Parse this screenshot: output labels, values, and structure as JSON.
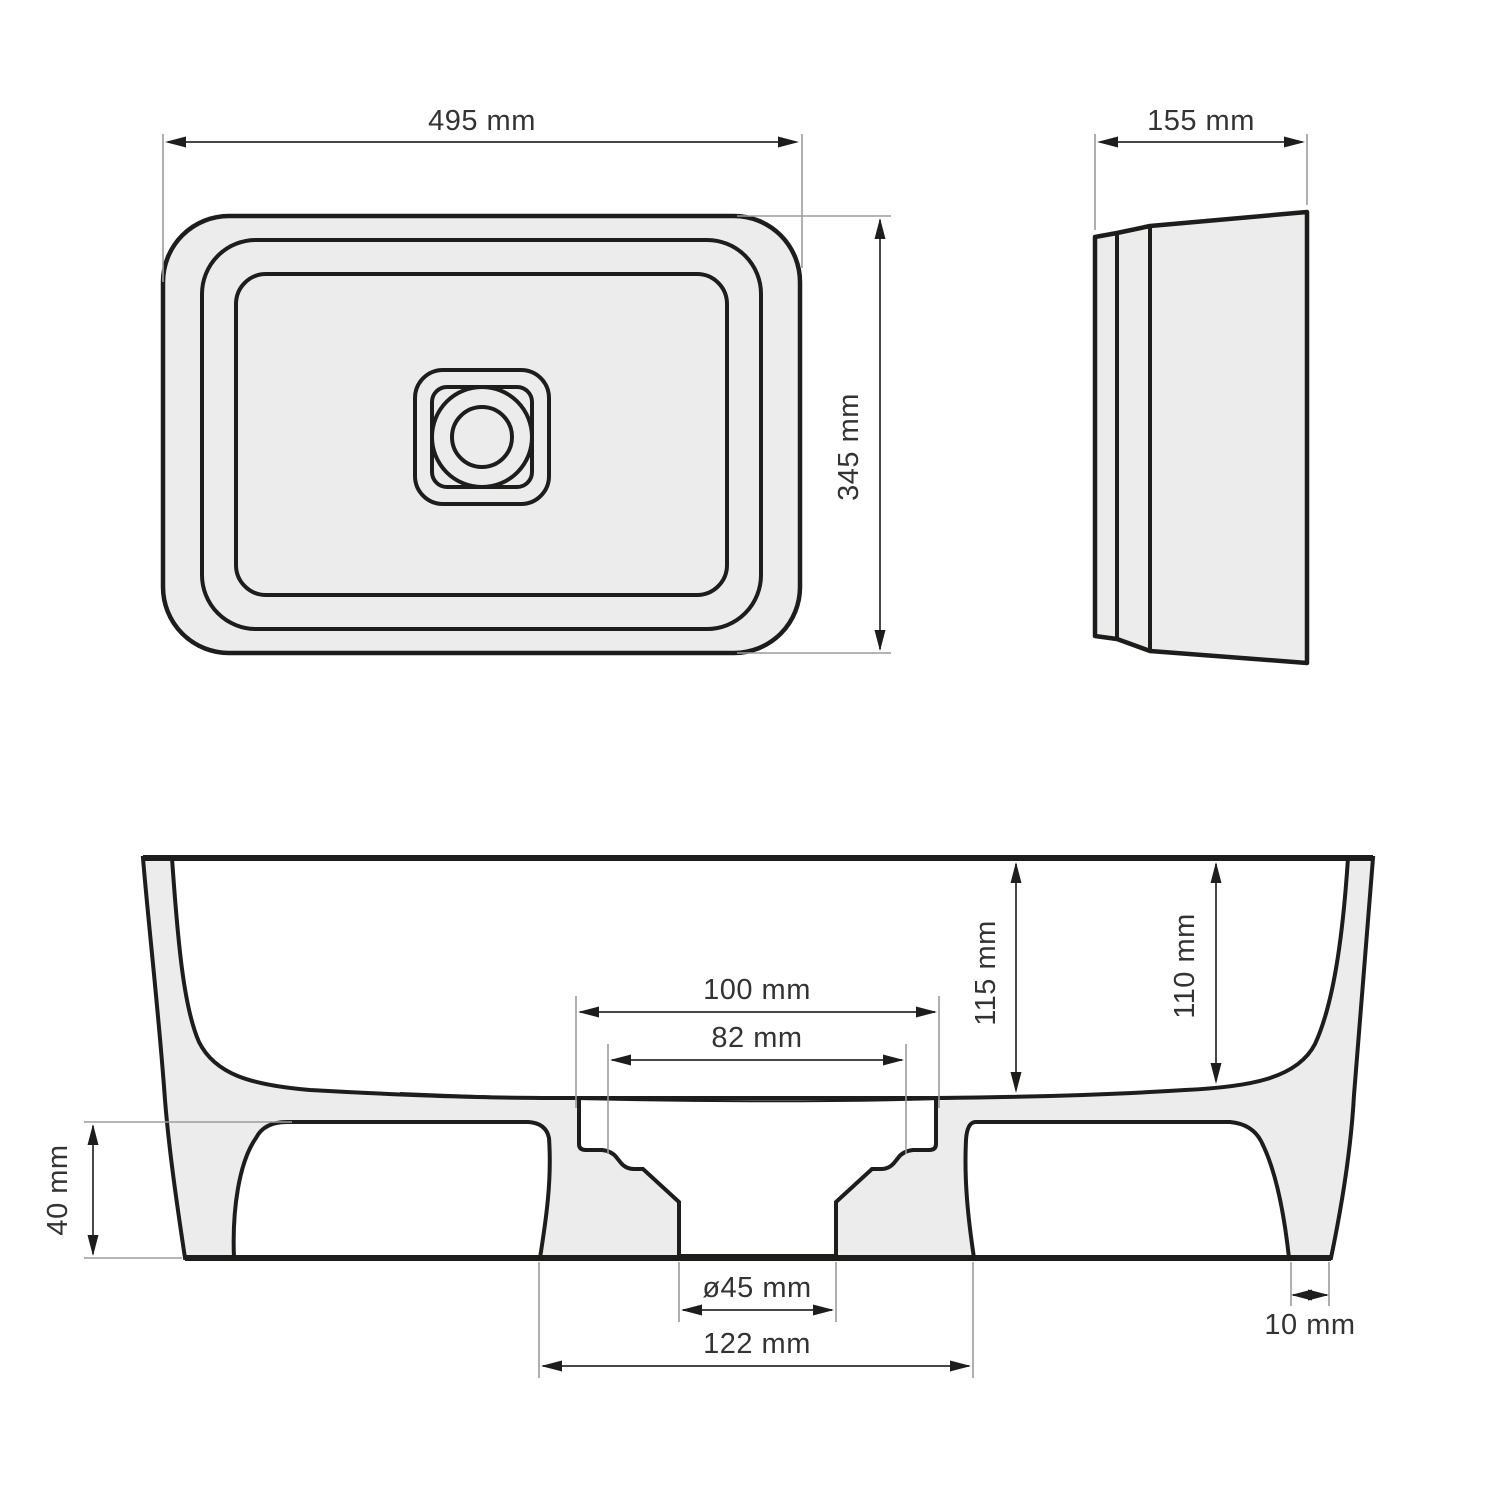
{
  "drawing": {
    "type": "technical-drawing-washbasin",
    "views": {
      "top_view": {
        "width_label": "495 mm",
        "depth_label": "345 mm"
      },
      "side_view": {
        "height_label": "155 mm"
      },
      "section_view": {
        "drain_recess_outer_label": "100 mm",
        "drain_recess_inner_label": "82 mm",
        "bowl_depth_center_label": "115 mm",
        "bowl_depth_edge_label": "110 mm",
        "base_height_label": "40 mm",
        "drain_diameter_label": "ø45 mm",
        "pedestal_width_label": "122 mm",
        "foot_width_label": "10 mm"
      }
    },
    "colors": {
      "background": "#ffffff",
      "part_fill": "#ececec",
      "outline": "#1d1d1b",
      "dimension_line": "#474747",
      "extension_line": "#9b9b9b",
      "text": "#333333"
    }
  }
}
